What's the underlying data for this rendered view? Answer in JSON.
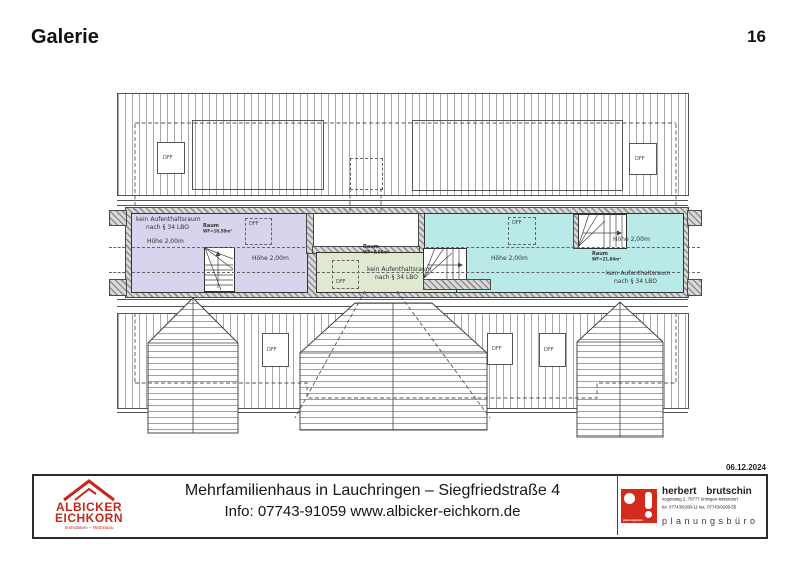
{
  "header": {
    "title": "Galerie",
    "page_number": "16"
  },
  "plan": {
    "labels": {
      "dff": "DFF",
      "no_living_line1": "kein Aufenthaltsraum",
      "no_living_line2": "nach § 34 LBO",
      "height": "Höhe 2,00m",
      "room": "Raum"
    },
    "rooms": {
      "left": {
        "area": "WF=18,58m²",
        "color": "#d9d3ee"
      },
      "middle": {
        "area": "WF=8,86m²",
        "color": "#dfe9d2"
      },
      "right": {
        "area": "WF=21,84m²",
        "color": "#b9eae8"
      }
    }
  },
  "titleblock": {
    "date": "06.12.2024",
    "project_line": "Mehrfamilienhaus in Lauchringen – Siegfriedstraße 4",
    "info_line": "Info: 07743-91059 www.albicker-eichkorn.de",
    "agency": {
      "name_line1": "ALBICKER",
      "name_line2": "EICHKORN",
      "subtitle": "Immobilien – Wohnbau",
      "brand_color": "#c4281c"
    },
    "planner": {
      "name": "herbert brutschin",
      "address": "vogelsang 2, 79777 ühlingen-birkendorf",
      "phone": "tel. 07743/9208-11  fax. 07743/9208-55",
      "type": "planungsbüro",
      "logo_text": "planungsbüro",
      "brand_color": "#d22b1e"
    }
  }
}
